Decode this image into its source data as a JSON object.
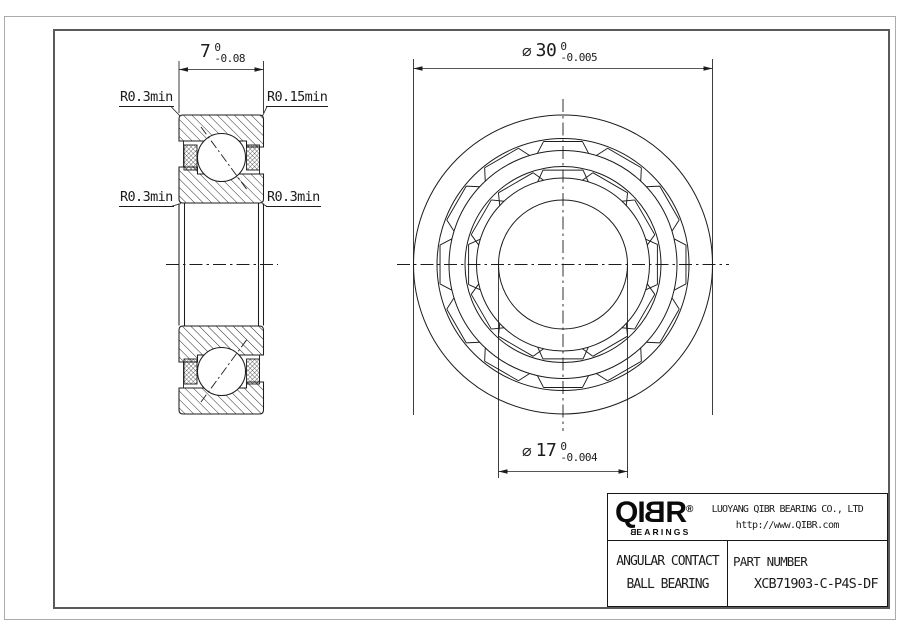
{
  "section_view": {
    "dim_width": {
      "value": "7",
      "tol_upper": "0",
      "tol_lower": "-0.08"
    },
    "fillet_top_left": "R0.3min",
    "fillet_top_right": "R0.15min",
    "fillet_bottom_left": "R0.3min",
    "fillet_bottom_right": "R0.3min"
  },
  "front_view": {
    "dim_outer": {
      "symbol": "⌀",
      "value": "30",
      "tol_upper": "0",
      "tol_lower": "-0.005"
    },
    "dim_bore": {
      "symbol": "⌀",
      "value": "17",
      "tol_upper": "0",
      "tol_lower": "-0.004"
    }
  },
  "title_block": {
    "logo_pre": "QI",
    "logo_mirrored": "B",
    "logo_post": "R",
    "registered": "®",
    "logo_sub_first": "B",
    "logo_sub_rest": "EARINGS",
    "company": "LUOYANG QIBR BEARING CO., LTD",
    "website": "http://www.QIBR.com",
    "product_line1": "ANGULAR CONTACT",
    "product_line2": "BALL BEARING",
    "part_label": "PART NUMBER",
    "part_number": "XCB71903-C-P4S-DF"
  }
}
